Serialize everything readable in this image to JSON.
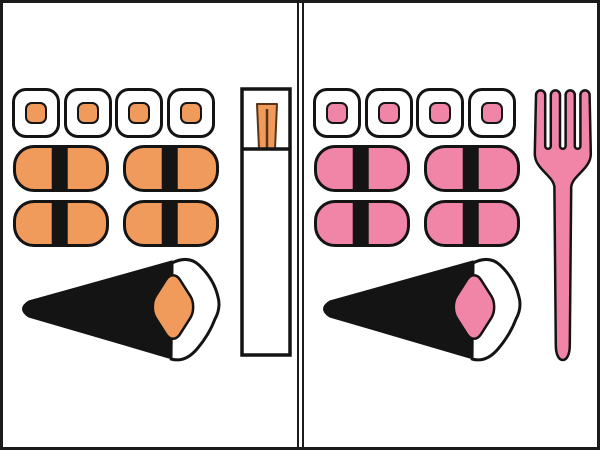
{
  "illustration": {
    "alt_text": "Two-panel comparison of an identical sushi set: left set in orange served with chopsticks in a paper sleeve, right set in pink served with a fork",
    "shared_colors": {
      "background": "#ffffff",
      "frame_border": "#1b1b1b",
      "outline": "#141414",
      "nori_black": "#141414",
      "rice_white": "#ffffff",
      "chopstick_detail": "#5a3414"
    },
    "panels": [
      {
        "side": "left",
        "accent_color": "#f09a5b",
        "utensil": "chopsticks in paper sleeve",
        "sushi": {
          "maki_rolls": 4,
          "nigiri_pieces": 4,
          "temaki_hand_rolls": 1
        }
      },
      {
        "side": "right",
        "accent_color": "#f085a8",
        "utensil": "fork",
        "sushi": {
          "maki_rolls": 4,
          "nigiri_pieces": 4,
          "temaki_hand_rolls": 1
        }
      }
    ]
  }
}
